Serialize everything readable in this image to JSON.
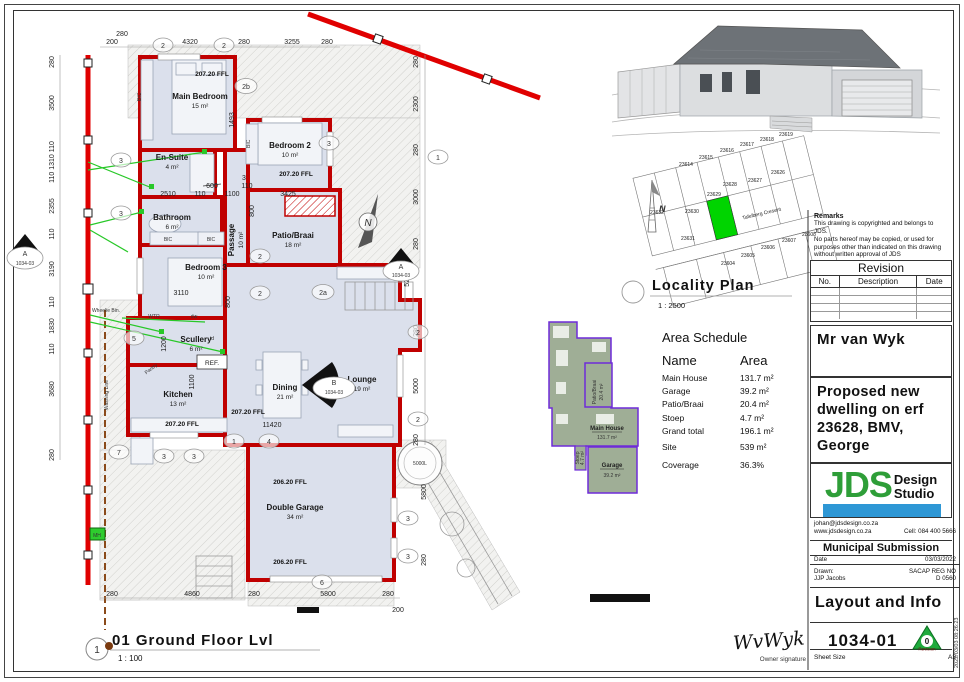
{
  "plan": {
    "rooms": {
      "main_bedroom": {
        "name": "Main Bedroom",
        "area": "15 m²"
      },
      "en_suite": {
        "name": "En-Suite",
        "area": "4 m²"
      },
      "bathroom": {
        "name": "Bathroom",
        "area": "6 m²"
      },
      "bedroom2": {
        "name": "Bedroom 2",
        "area": "10 m²"
      },
      "bedroom3": {
        "name": "Bedroom 3",
        "area": "10 m²"
      },
      "passage": {
        "name": "Passage",
        "area": "10 m²"
      },
      "patio": {
        "name": "Patio/Braai",
        "area": "18 m²"
      },
      "scullery": {
        "name": "Scullery",
        "area": "6 m²"
      },
      "kitchen": {
        "name": "Kitchen",
        "area": "13 m²"
      },
      "dining": {
        "name": "Dining",
        "area": "21 m²"
      },
      "lounge": {
        "name": "Lounge",
        "area": "19 m²"
      },
      "garage": {
        "name": "Double Garage",
        "area": "34 m²"
      }
    },
    "ffl_main": "207.20 FFL",
    "ffl_garage": "206.20 FFL",
    "labels": {
      "bic": "BIC",
      "ref": "REF.",
      "pantry": "Pantry",
      "wtr": "WTR",
      "dw": "dw",
      "td": "td",
      "wheelie": "Wheelie Bin.",
      "washing": "Washing Line",
      "mh": "MH",
      "tank": "5000L",
      "north": "N"
    },
    "dims": {
      "top": [
        "280",
        "200",
        "4320",
        "280",
        "3255",
        "280"
      ],
      "left": [
        "280",
        "3500",
        "110 1310 110",
        "2355",
        "110",
        "3190",
        "110",
        "1830",
        "110",
        "3680",
        "280"
      ],
      "right": [
        "280",
        "2300",
        "280",
        "3000",
        "280",
        "5275",
        "280",
        "5000",
        "280"
      ],
      "garage_right": [
        "5800",
        "280"
      ],
      "bottom": [
        "280",
        "4860",
        "280",
        "5800",
        "280",
        "200"
      ],
      "inner": [
        "1493",
        "600",
        "2510",
        "110",
        "1100",
        "3425",
        "3",
        "110",
        "800",
        "800",
        "3110",
        "1200",
        "1100",
        "11420"
      ]
    },
    "bubbles": [
      "2",
      "2",
      "2b",
      "3",
      "1",
      "3",
      "3",
      "2",
      "2",
      "2a",
      "5",
      "7",
      "3",
      "3",
      "1",
      "4",
      "6",
      "2",
      "2",
      "3",
      "3"
    ],
    "sections": {
      "a": "A",
      "b": "B",
      "ref": "1034-03"
    }
  },
  "locality": {
    "title": "Locality Plan",
    "scale": "1 : 2500",
    "street": "Tafelberg Cresent",
    "north": "N",
    "erven": [
      "23614",
      "23615",
      "23616",
      "23617",
      "23618",
      "23619",
      "23632",
      "23630",
      "23629",
      "23628",
      "23627",
      "23626",
      "23631",
      "23604",
      "23605",
      "23606",
      "23607",
      "23608"
    ]
  },
  "schedule": {
    "title": "Area Schedule",
    "col_name": "Name",
    "col_area": "Area",
    "rows": [
      [
        "Main House",
        "131.7 m²"
      ],
      [
        "Garage",
        "39.2 m²"
      ],
      [
        "Patio/Braai",
        "20.4 m²"
      ],
      [
        "Stoep",
        "4.7 m²"
      ],
      [
        "Grand total",
        "196.1 m²"
      ],
      [
        "Site",
        "539 m²"
      ],
      [
        "Coverage",
        "36.3%"
      ]
    ]
  },
  "mini": {
    "main": "Main House",
    "main_area": "131.7 m²",
    "garage": "Garage",
    "garage_area": "39.2 m²",
    "patio": "Patio/Braai",
    "patio_area": "20.4 m²",
    "stoep": "Stoep",
    "stoep_area": "4.7 m²"
  },
  "titleblock": {
    "remarks_title": "Remarks",
    "remarks_body": "This drawing is copyrighted and belongs to JDS.\nNo parts hereof may be copied, or used for purposes other than indicated on this drawing without written approval of JDS",
    "revision_title": "Revision",
    "rev_no": "No.",
    "rev_desc": "Description",
    "rev_date": "Date",
    "client": "Mr van Wyk",
    "project": "Proposed new\ndwelling on erf\n23628, BMV,\nGeorge",
    "logo_jds": "JDS",
    "logo_design": "Design",
    "logo_studio": "Studio",
    "email": "johan@jdsdesign.co.za",
    "web": "www.jdsdesign.co.za",
    "cell": "Cell: 084 400 5666",
    "submission": "Municipal Submission",
    "date_label": "Date",
    "date": "03/03/2022",
    "drawn_label": "Drawn:",
    "drawn": "JJP Jacobs",
    "sacap": "SACAP REG NO",
    "sacap_no": "D 0560",
    "sheet_title": "Layout and Info",
    "number": "1034-01",
    "revision_tri": "0",
    "revision_word": "Revision",
    "sheet_size_label": "Sheet Size",
    "sheet_size": "A3"
  },
  "footer": {
    "marker": "1",
    "title": "01 Ground Floor Lvl",
    "scale": "1 : 100",
    "signature": "WvWyk",
    "signature_label": "Owner signature"
  },
  "meta": {
    "timestamp": "2022/03/03 08:26:23"
  },
  "colors": {
    "wall": "#c00000",
    "floor": "#dbe0ec",
    "boundary": "#e00000",
    "highlight": "#00d400",
    "logo_green": "#2e9e38",
    "logo_blue": "#2e97d5",
    "electric": "#28c828",
    "mini_fill": "#9fae96",
    "mini_stroke": "#6f2bd8"
  }
}
